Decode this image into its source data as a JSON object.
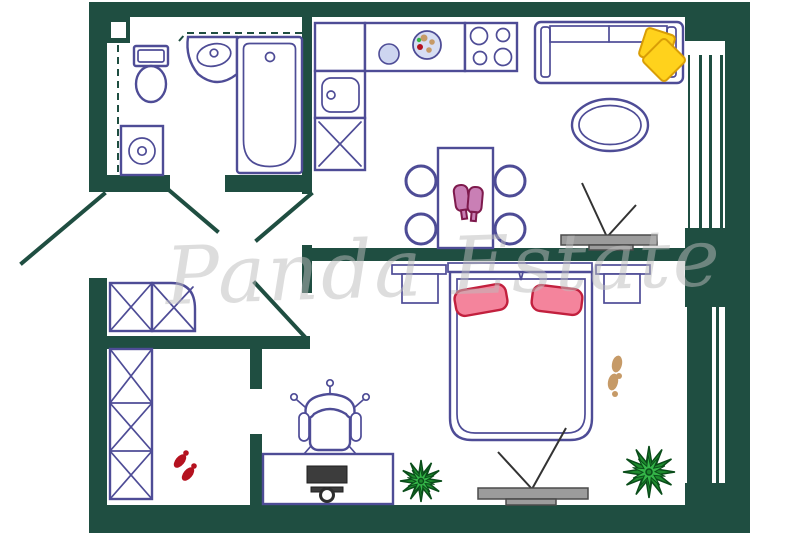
{
  "watermark": {
    "text": "Panda Estate"
  },
  "palette": {
    "wall": "#1F4E41",
    "line": "#4E4C96",
    "tv": "#9C9C9C",
    "tvDark": "#3C3C3C",
    "yellow": "#FFD21C",
    "yellowLine": "#D99E06",
    "pink": "#F4849C",
    "pinkLine": "#C2203E",
    "glass": "#C97FB5",
    "glassLine": "#7E1A4D",
    "plantLight": "#35B548",
    "plantDark": "#1E8C2E",
    "plantLine": "#0A4D1A",
    "tan": "#C69A67",
    "red": "#B5121F",
    "dish": "#D7DEF3",
    "dishLight": "#CDD5F0",
    "watermark": "#BDBDBD"
  },
  "plan": {
    "rooms": [
      "bathroom",
      "kitchen",
      "living-room",
      "bedroom",
      "hallway",
      "walk-in-closet"
    ],
    "furniture": [
      "toilet",
      "corner-sink",
      "bathtub",
      "washing-machine",
      "kitchen-counter",
      "kitchen-sink",
      "stove-4-burners",
      "dining-table",
      "dining-chairs",
      "wine-glasses",
      "sofa",
      "yellow-pillows",
      "oval-rug",
      "tv-on-stand",
      "double-bed",
      "pink-pillows",
      "nightstands",
      "potted-plants",
      "footprints",
      "red-slippers",
      "corner-wardrobe",
      "tall-wardrobe",
      "desk",
      "office-chair",
      "computer-monitor"
    ],
    "windows": 2,
    "doors": 4
  }
}
